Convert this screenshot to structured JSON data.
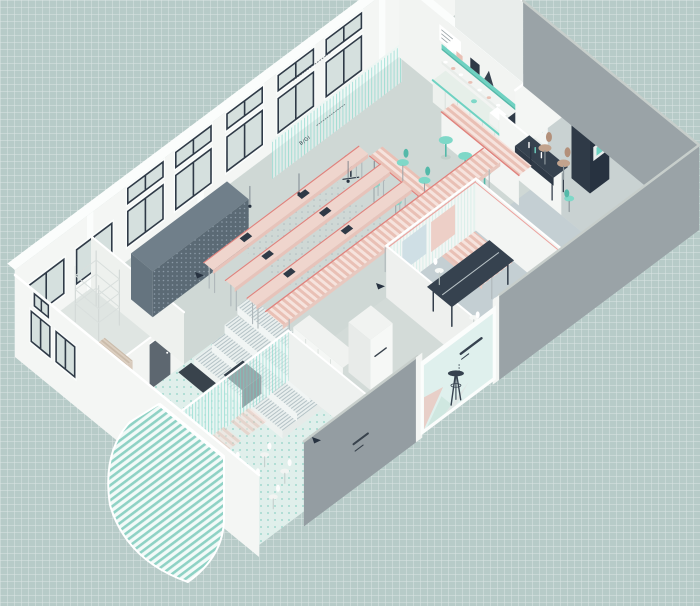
{
  "scene": {
    "type": "axonometric-interior-cutaway-illustration",
    "wall_label": "B/GI",
    "elements": [
      "grid-paper-background",
      "floor-slab",
      "back-window-wall",
      "clerestory-windows",
      "glass-balustrade",
      "left-bedroom",
      "slate-storage-wall",
      "kitchen-bar",
      "teal-shelving",
      "bar-stools",
      "high-table",
      "communal-desks",
      "striped-counter",
      "tiered-platform",
      "wardrobe-cabinets",
      "conference-room",
      "navy-conference-table",
      "office-nook",
      "navy-desk",
      "media-shelf",
      "storage-room",
      "meeting-lounge",
      "striped-glass-partition",
      "curved-striped-canopy",
      "storefront-window",
      "stool-silhouette",
      "gray-facade-walls",
      "marker-arrows"
    ]
  },
  "palette": {
    "bg": "#b7cbc8",
    "white": "#f4f6f4",
    "white_bright": "#fbfdfc",
    "white_shade": "#e9edeb",
    "floor": "#d8dfdc",
    "floor_hall": "#cfd8d5",
    "floor_dark": "#c4cfd3",
    "floor_office": "#c9d2d2",
    "floor_mint": "#e0efeb",
    "floor_store": "#ccd5d2",
    "floor_left": "#dfe5e2",
    "floor_corridor": "#d3dbd8",
    "gray_wall": "#949da2",
    "gray_wall2": "#9aa3a7",
    "gray_top": "#c7cecb",
    "navy": "#2f3a47",
    "navy_dark": "#273240",
    "navy_mid": "#36424f",
    "slate": "#5b6a75",
    "slate_top": "#707f8a",
    "slate_side": "#65747f",
    "mint": "#6fd2c2",
    "mint_deep": "#54b9a9",
    "mint_chair": "#7fd8c8",
    "mint_pale": "#d6efe9",
    "pink": "#efd5cd",
    "pink_mid": "#e9c0b5",
    "pink_edge": "#e0827d",
    "pink_pale": "#f6e3dd",
    "tan": "#c2a38d",
    "tan_dark": "#b3907a",
    "glass": "#dcefeb",
    "glass_pane": "#d5e0de",
    "door": "#5d6770",
    "ink": "#39434d",
    "hatch": "#b4c2c6",
    "dot_gray": "#afbcbf",
    "dot_mint": "#8fd2c5",
    "beige": "#cabbaa"
  }
}
